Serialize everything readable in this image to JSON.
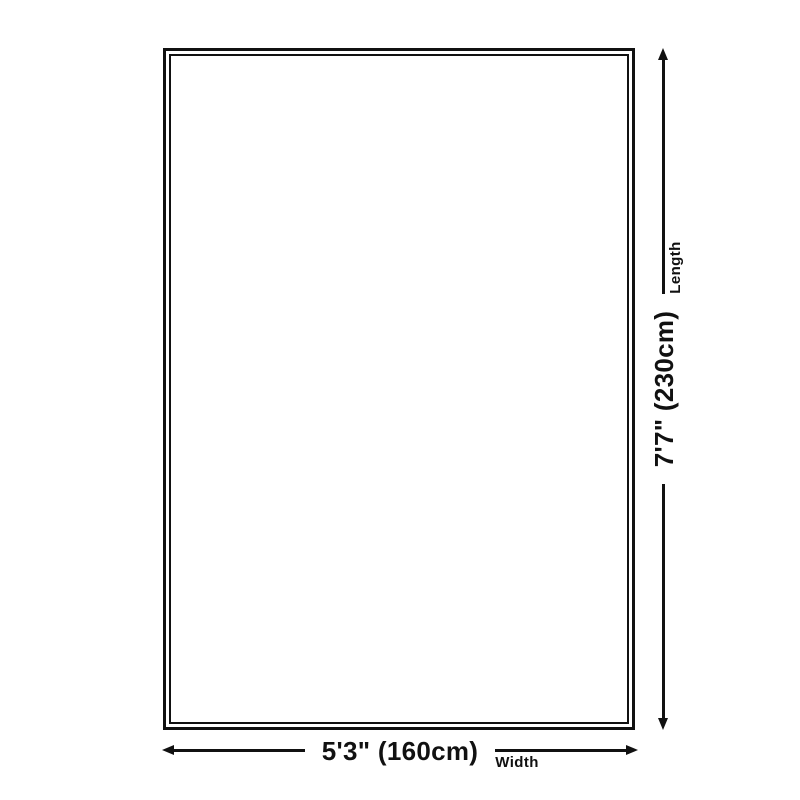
{
  "diagram": {
    "type": "product-size-diagram",
    "shape": "rectangle-double-border",
    "colors": {
      "ink": "#111111",
      "bg": "#ffffff"
    },
    "dimensions": {
      "width": {
        "value": "5'3\" (160cm)",
        "label": "Width"
      },
      "length": {
        "value": "7'7\" (230cm)",
        "label": "Length"
      }
    }
  }
}
